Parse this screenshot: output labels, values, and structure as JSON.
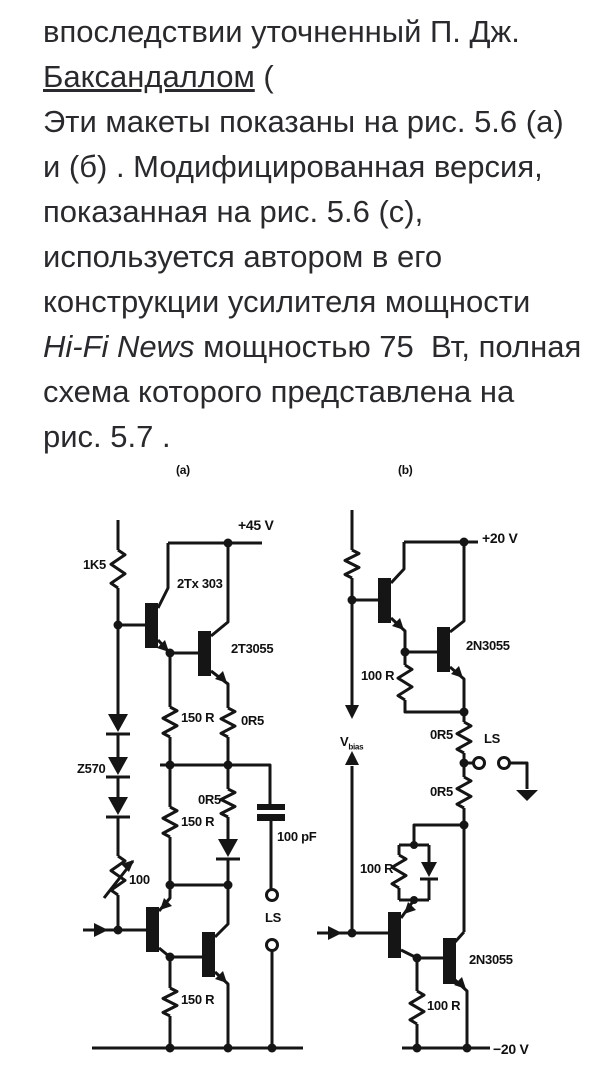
{
  "ink": "#151515",
  "text_color": "#2a2a2e",
  "paragraph": {
    "lines": [
      {
        "segments": [
          {
            "text": "впоследствии уточненный П. Дж."
          }
        ]
      },
      {
        "segments": [
          {
            "text": "Баксандаллом",
            "link": true
          },
          {
            "text": " ("
          }
        ]
      },
      {
        "segments": [
          {
            "text": "Эти макеты показаны на рис. 5.6 (а)"
          }
        ]
      },
      {
        "segments": [
          {
            "text": "и (б) . Модифицированная версия,"
          }
        ]
      },
      {
        "segments": [
          {
            "text": "показанная на рис. 5.6 (с),"
          }
        ]
      },
      {
        "segments": [
          {
            "text": "используется автором в его"
          }
        ]
      },
      {
        "segments": [
          {
            "text": "конструкции усилителя мощности"
          }
        ]
      },
      {
        "segments": [
          {
            "text": "Hi-Fi News",
            "italic": true
          },
          {
            "text": " мощностью 75  Вт, полная"
          }
        ]
      },
      {
        "segments": [
          {
            "text": "схема которого представлена на"
          }
        ]
      },
      {
        "segments": [
          {
            "text": "рис. 5.7 ."
          }
        ]
      }
    ]
  },
  "figure": {
    "labels": [
      {
        "name": "panel-a-label",
        "text": "(a)",
        "x": 176,
        "y": 464,
        "fs": 12
      },
      {
        "name": "supply-pos-a-label",
        "text": "+45 V",
        "x": 238,
        "y": 518,
        "fs": 14
      },
      {
        "name": "resistor-1k5-label",
        "text": "1K5",
        "x": 83,
        "y": 558,
        "fs": 13
      },
      {
        "name": "transistor-2tx303-label",
        "text": "2Tx 303",
        "x": 177,
        "y": 577,
        "fs": 13
      },
      {
        "name": "transistor-2t3055-label",
        "text": "2T3055",
        "x": 231,
        "y": 642,
        "fs": 13
      },
      {
        "name": "resistor-150r-1-label",
        "text": "150 R",
        "x": 181,
        "y": 711,
        "fs": 13
      },
      {
        "name": "resistor-0r5-a1-label",
        "text": "0R5",
        "x": 241,
        "y": 714,
        "fs": 13
      },
      {
        "name": "diode-z570-label",
        "text": "Z570",
        "x": 77,
        "y": 762,
        "fs": 13
      },
      {
        "name": "resistor-0r5-a2-label",
        "text": "0R5",
        "x": 198,
        "y": 793,
        "fs": 13
      },
      {
        "name": "resistor-150r-2-label",
        "text": "150 R",
        "x": 181,
        "y": 815,
        "fs": 13
      },
      {
        "name": "capacitor-100pf-label",
        "text": "100 pF",
        "x": 277,
        "y": 830,
        "fs": 13
      },
      {
        "name": "trimmer-100-label",
        "text": "100",
        "x": 129,
        "y": 873,
        "fs": 13
      },
      {
        "name": "speaker-a-label",
        "text": "LS",
        "x": 265,
        "y": 911,
        "fs": 13
      },
      {
        "name": "resistor-150r-3-label",
        "text": "150 R",
        "x": 181,
        "y": 993,
        "fs": 13
      },
      {
        "name": "panel-b-label",
        "text": "(b)",
        "x": 398,
        "y": 464,
        "fs": 12
      },
      {
        "name": "supply-pos-b-label",
        "text": "+20 V",
        "x": 482,
        "y": 531,
        "fs": 14
      },
      {
        "name": "transistor-2n3055-1-label",
        "text": "2N3055",
        "x": 466,
        "y": 639,
        "fs": 13
      },
      {
        "name": "resistor-100r-b1-label",
        "text": "100 R",
        "x": 361,
        "y": 669,
        "fs": 13
      },
      {
        "name": "vbias-label",
        "text": "V",
        "sub": "bias",
        "x": 340,
        "y": 735,
        "fs": 13
      },
      {
        "name": "resistor-0r5-b1-label",
        "text": "0R5",
        "x": 430,
        "y": 728,
        "fs": 13
      },
      {
        "name": "speaker-b-label",
        "text": "LS",
        "x": 484,
        "y": 732,
        "fs": 13
      },
      {
        "name": "resistor-0r5-b2-label",
        "text": "0R5",
        "x": 430,
        "y": 785,
        "fs": 13
      },
      {
        "name": "resistor-100r-b2-label",
        "text": "100 R",
        "x": 360,
        "y": 862,
        "fs": 13
      },
      {
        "name": "transistor-2n3055-2-label",
        "text": "2N3055",
        "x": 469,
        "y": 953,
        "fs": 13
      },
      {
        "name": "resistor-100r-b3-label",
        "text": "100 R",
        "x": 427,
        "y": 999,
        "fs": 13
      },
      {
        "name": "supply-neg-b-label",
        "text": "−20 V",
        "x": 493,
        "y": 1042,
        "fs": 14
      }
    ]
  }
}
